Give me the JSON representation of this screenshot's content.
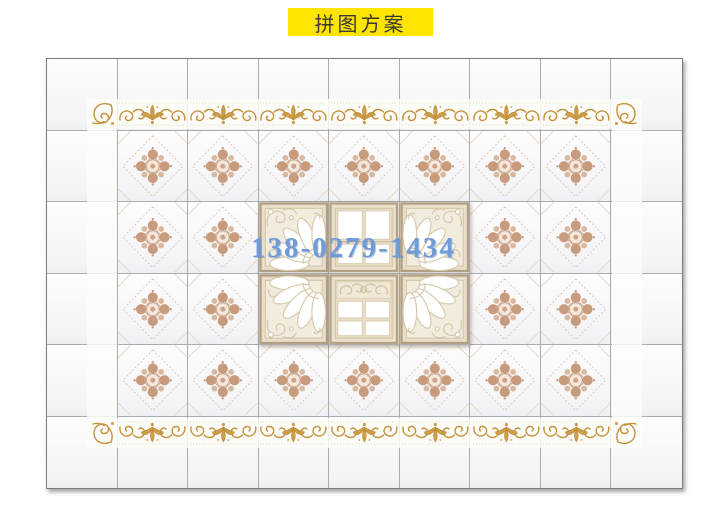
{
  "title": {
    "label": "拼图方案"
  },
  "watermark": {
    "text": "138-0279-1434"
  },
  "colors": {
    "banner_bg": "#ffe400",
    "banner_text": "#3a3a32",
    "watermark_blue": "#6f9bd8",
    "scroll_gold": "#c6923c",
    "medallion_rose": "#c89b7d",
    "tile_frame_beige": "#b3a083",
    "grid_line": "#abacb2"
  },
  "panel": {
    "rows": 6,
    "cols": 9,
    "layout": [
      [
        "P",
        "P",
        "P",
        "P",
        "P",
        "P",
        "P",
        "P",
        "P"
      ],
      [
        "P",
        "M",
        "M",
        "M",
        "M",
        "M",
        "M",
        "M",
        "P"
      ],
      [
        "P",
        "M",
        "M",
        "FA",
        "W1",
        "FB",
        "M",
        "M",
        "P"
      ],
      [
        "P",
        "M",
        "M",
        "FC",
        "W2",
        "FD",
        "M",
        "M",
        "P"
      ],
      [
        "P",
        "M",
        "M",
        "M",
        "M",
        "M",
        "M",
        "M",
        "P"
      ],
      [
        "P",
        "P",
        "P",
        "P",
        "P",
        "P",
        "P",
        "P",
        "P"
      ]
    ],
    "tile_types": {
      "P": "plain-tile",
      "M": "medallion-tile",
      "FA": "fan-corner-tile-top-left",
      "FB": "fan-corner-tile-top-right",
      "FC": "fan-corner-tile-bottom-left",
      "FD": "fan-corner-tile-bottom-right",
      "W1": "window-pane-tile",
      "W2": "window-scroll-pane-tile"
    },
    "border": {
      "style": "gold-scroll-frieze",
      "sides": [
        "top",
        "right",
        "bottom",
        "left"
      ],
      "corner_motifs": 4
    }
  }
}
